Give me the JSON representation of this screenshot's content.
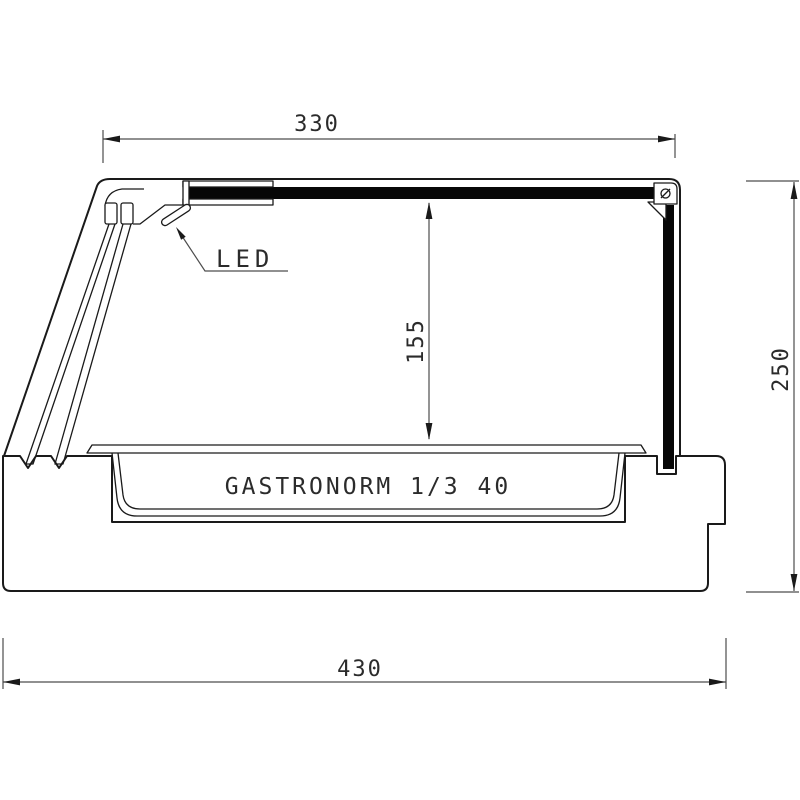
{
  "drawing": {
    "pan_label": "GASTRONORM 1/3 40",
    "led_label": "LED",
    "dims": {
      "top_width": "330",
      "inner_height": "155",
      "overall_height": "250",
      "overall_depth": "430"
    },
    "colors": {
      "outline": "#1a1a1a",
      "dimension_line": "#4d4d4d",
      "glass_panel_fill": "#070707",
      "text": "#2b2b2b",
      "background": "#ffffff"
    }
  }
}
